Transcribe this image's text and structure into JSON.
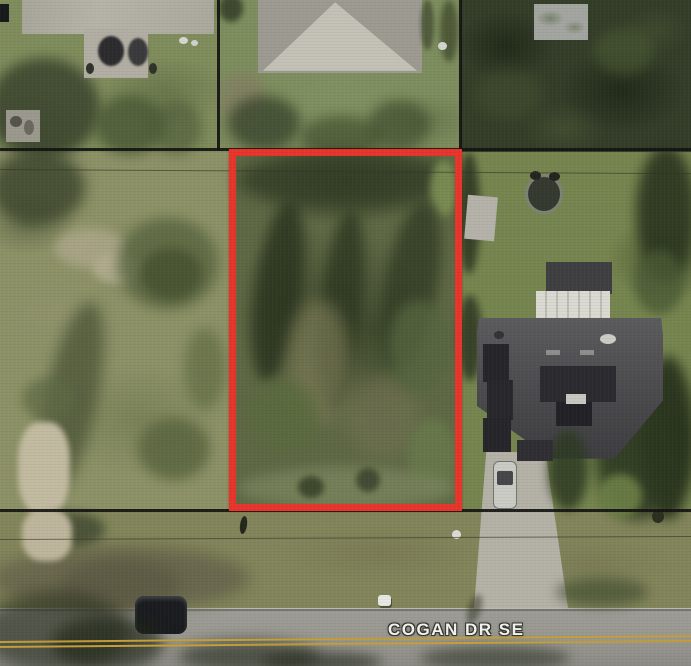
{
  "map": {
    "street_label": "COGAN DR SE",
    "colors": {
      "parcel_outline": "#e7352b",
      "boundary_line": "#131313",
      "road_centerline": "#c49e38",
      "street_label_text": "#f2f2ee"
    }
  }
}
